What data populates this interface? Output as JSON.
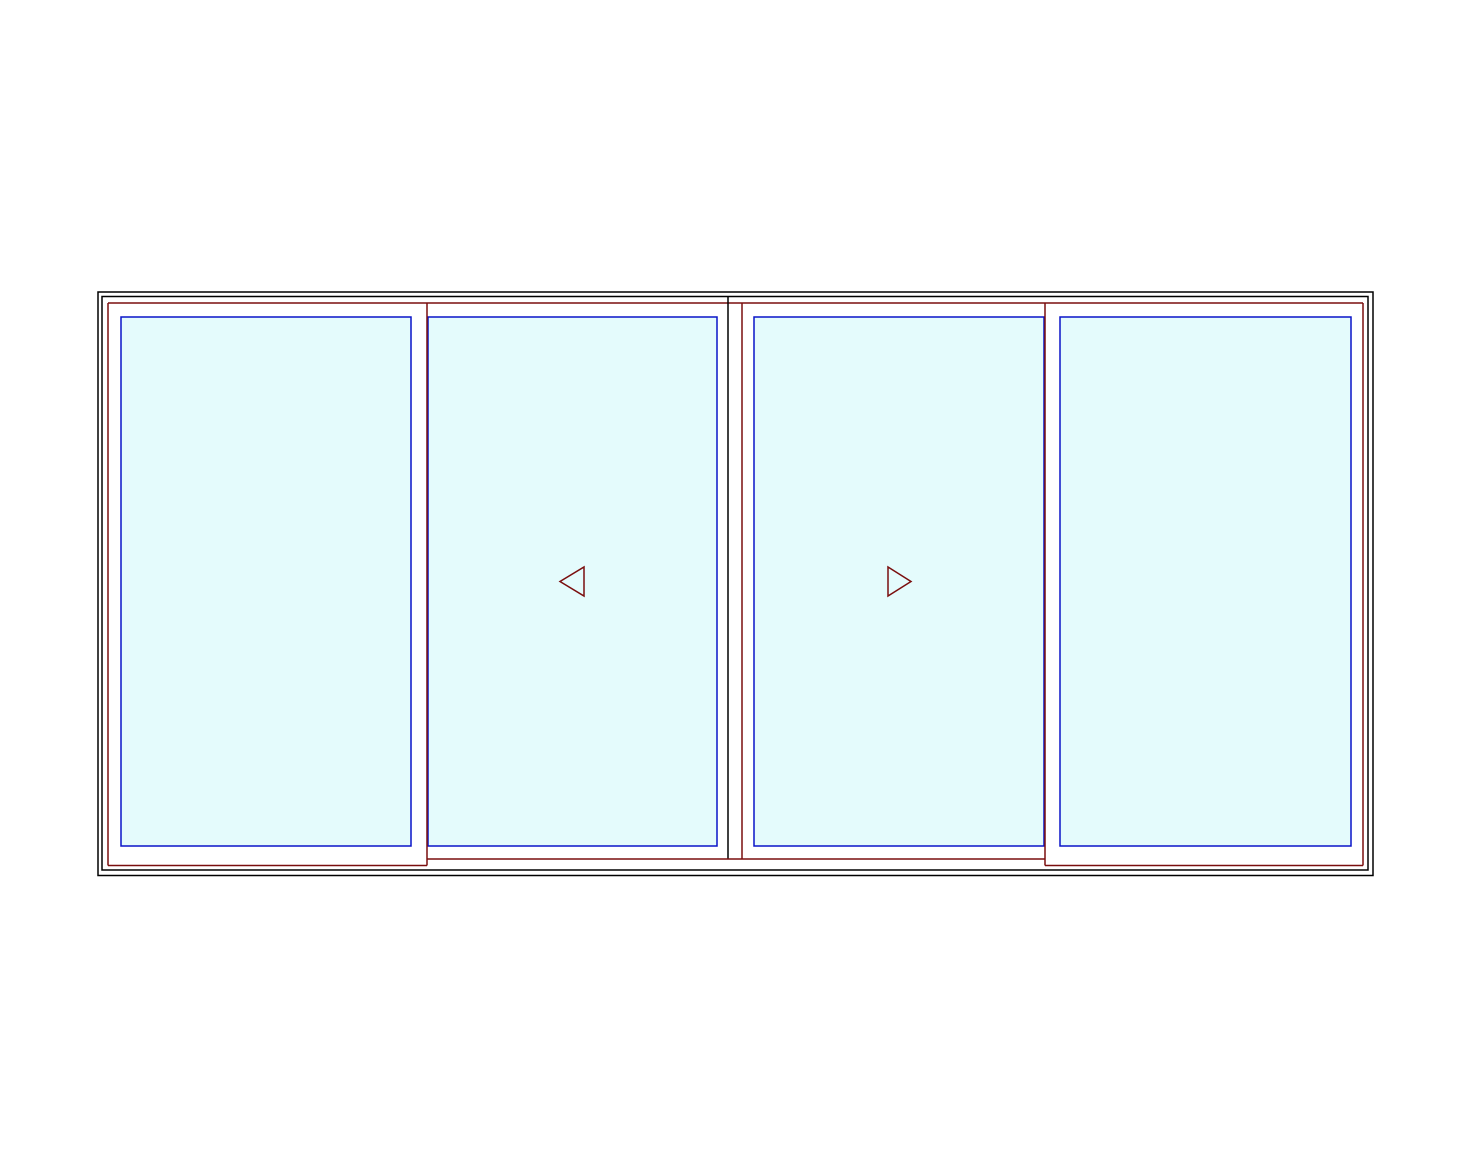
{
  "canvas": {
    "width": 1483,
    "height": 1171,
    "background": "#ffffff"
  },
  "colors": {
    "frame": "#000000",
    "sash": "#7a0e0e",
    "glass_border": "#0a14c8",
    "glass_fill": "#e4fbfc",
    "background": "#ffffff"
  },
  "drawing": {
    "description_elements": [
      {
        "kind": "rect",
        "name": "frame-outer",
        "x": 98,
        "y": 292,
        "w": 1275,
        "h": 583.5,
        "stroke": "frame",
        "fill": "none"
      },
      {
        "kind": "rect",
        "name": "frame-inner",
        "x": 102,
        "y": 296.5,
        "w": 1266,
        "h": 573.5,
        "stroke": "frame",
        "fill": "none"
      },
      {
        "kind": "rect",
        "name": "glass-panel-1",
        "x": 121,
        "y": 317,
        "w": 290,
        "h": 529,
        "stroke": "glass_border",
        "fill": "glass_fill"
      },
      {
        "kind": "rect",
        "name": "glass-panel-2",
        "x": 428,
        "y": 317,
        "w": 289,
        "h": 529,
        "stroke": "glass_border",
        "fill": "glass_fill"
      },
      {
        "kind": "rect",
        "name": "glass-panel-3",
        "x": 754,
        "y": 317,
        "w": 290,
        "h": 529,
        "stroke": "glass_border",
        "fill": "glass_fill"
      },
      {
        "kind": "rect",
        "name": "glass-panel-4",
        "x": 1060,
        "y": 317,
        "w": 291,
        "h": 529,
        "stroke": "glass_border",
        "fill": "glass_fill"
      },
      {
        "kind": "line",
        "name": "sash-top-rail",
        "x1": 108,
        "y1": 303,
        "x2": 1363,
        "y2": 303,
        "stroke": "sash"
      },
      {
        "kind": "line",
        "name": "sash-left-stile",
        "x1": 108,
        "y1": 303,
        "x2": 108,
        "y2": 865.5,
        "stroke": "sash"
      },
      {
        "kind": "line",
        "name": "sash-junction-left",
        "x1": 427,
        "y1": 303,
        "x2": 427,
        "y2": 865.5,
        "stroke": "sash"
      },
      {
        "kind": "line",
        "name": "center-interlock",
        "x1": 728,
        "y1": 296.5,
        "x2": 728,
        "y2": 859,
        "stroke": "frame"
      },
      {
        "kind": "line",
        "name": "sash-center-stile",
        "x1": 742,
        "y1": 303,
        "x2": 742,
        "y2": 859,
        "stroke": "sash"
      },
      {
        "kind": "line",
        "name": "sash-junction-right",
        "x1": 1045,
        "y1": 303,
        "x2": 1045,
        "y2": 865.5,
        "stroke": "sash"
      },
      {
        "kind": "line",
        "name": "sash-right-stile",
        "x1": 1363,
        "y1": 303,
        "x2": 1363,
        "y2": 865.5,
        "stroke": "sash"
      },
      {
        "kind": "line",
        "name": "sash-bottom-rail-panel-1",
        "x1": 108,
        "y1": 865.5,
        "x2": 427,
        "y2": 865.5,
        "stroke": "sash"
      },
      {
        "kind": "line",
        "name": "sash-bottom-rail-middle",
        "x1": 427,
        "y1": 859,
        "x2": 1045,
        "y2": 859,
        "stroke": "sash"
      },
      {
        "kind": "line",
        "name": "sash-bottom-rail-panel-4",
        "x1": 1045,
        "y1": 865.5,
        "x2": 1363,
        "y2": 865.5,
        "stroke": "sash"
      },
      {
        "kind": "polygon",
        "name": "slide-left-arrow-icon",
        "points": "584,567 584,596 560,581.5",
        "stroke": "sash",
        "fill": "none"
      },
      {
        "kind": "polygon",
        "name": "slide-right-arrow-icon",
        "points": "888,567 888,596 911,581.5",
        "stroke": "sash",
        "fill": "none"
      }
    ],
    "stroke_width": 1.5
  }
}
